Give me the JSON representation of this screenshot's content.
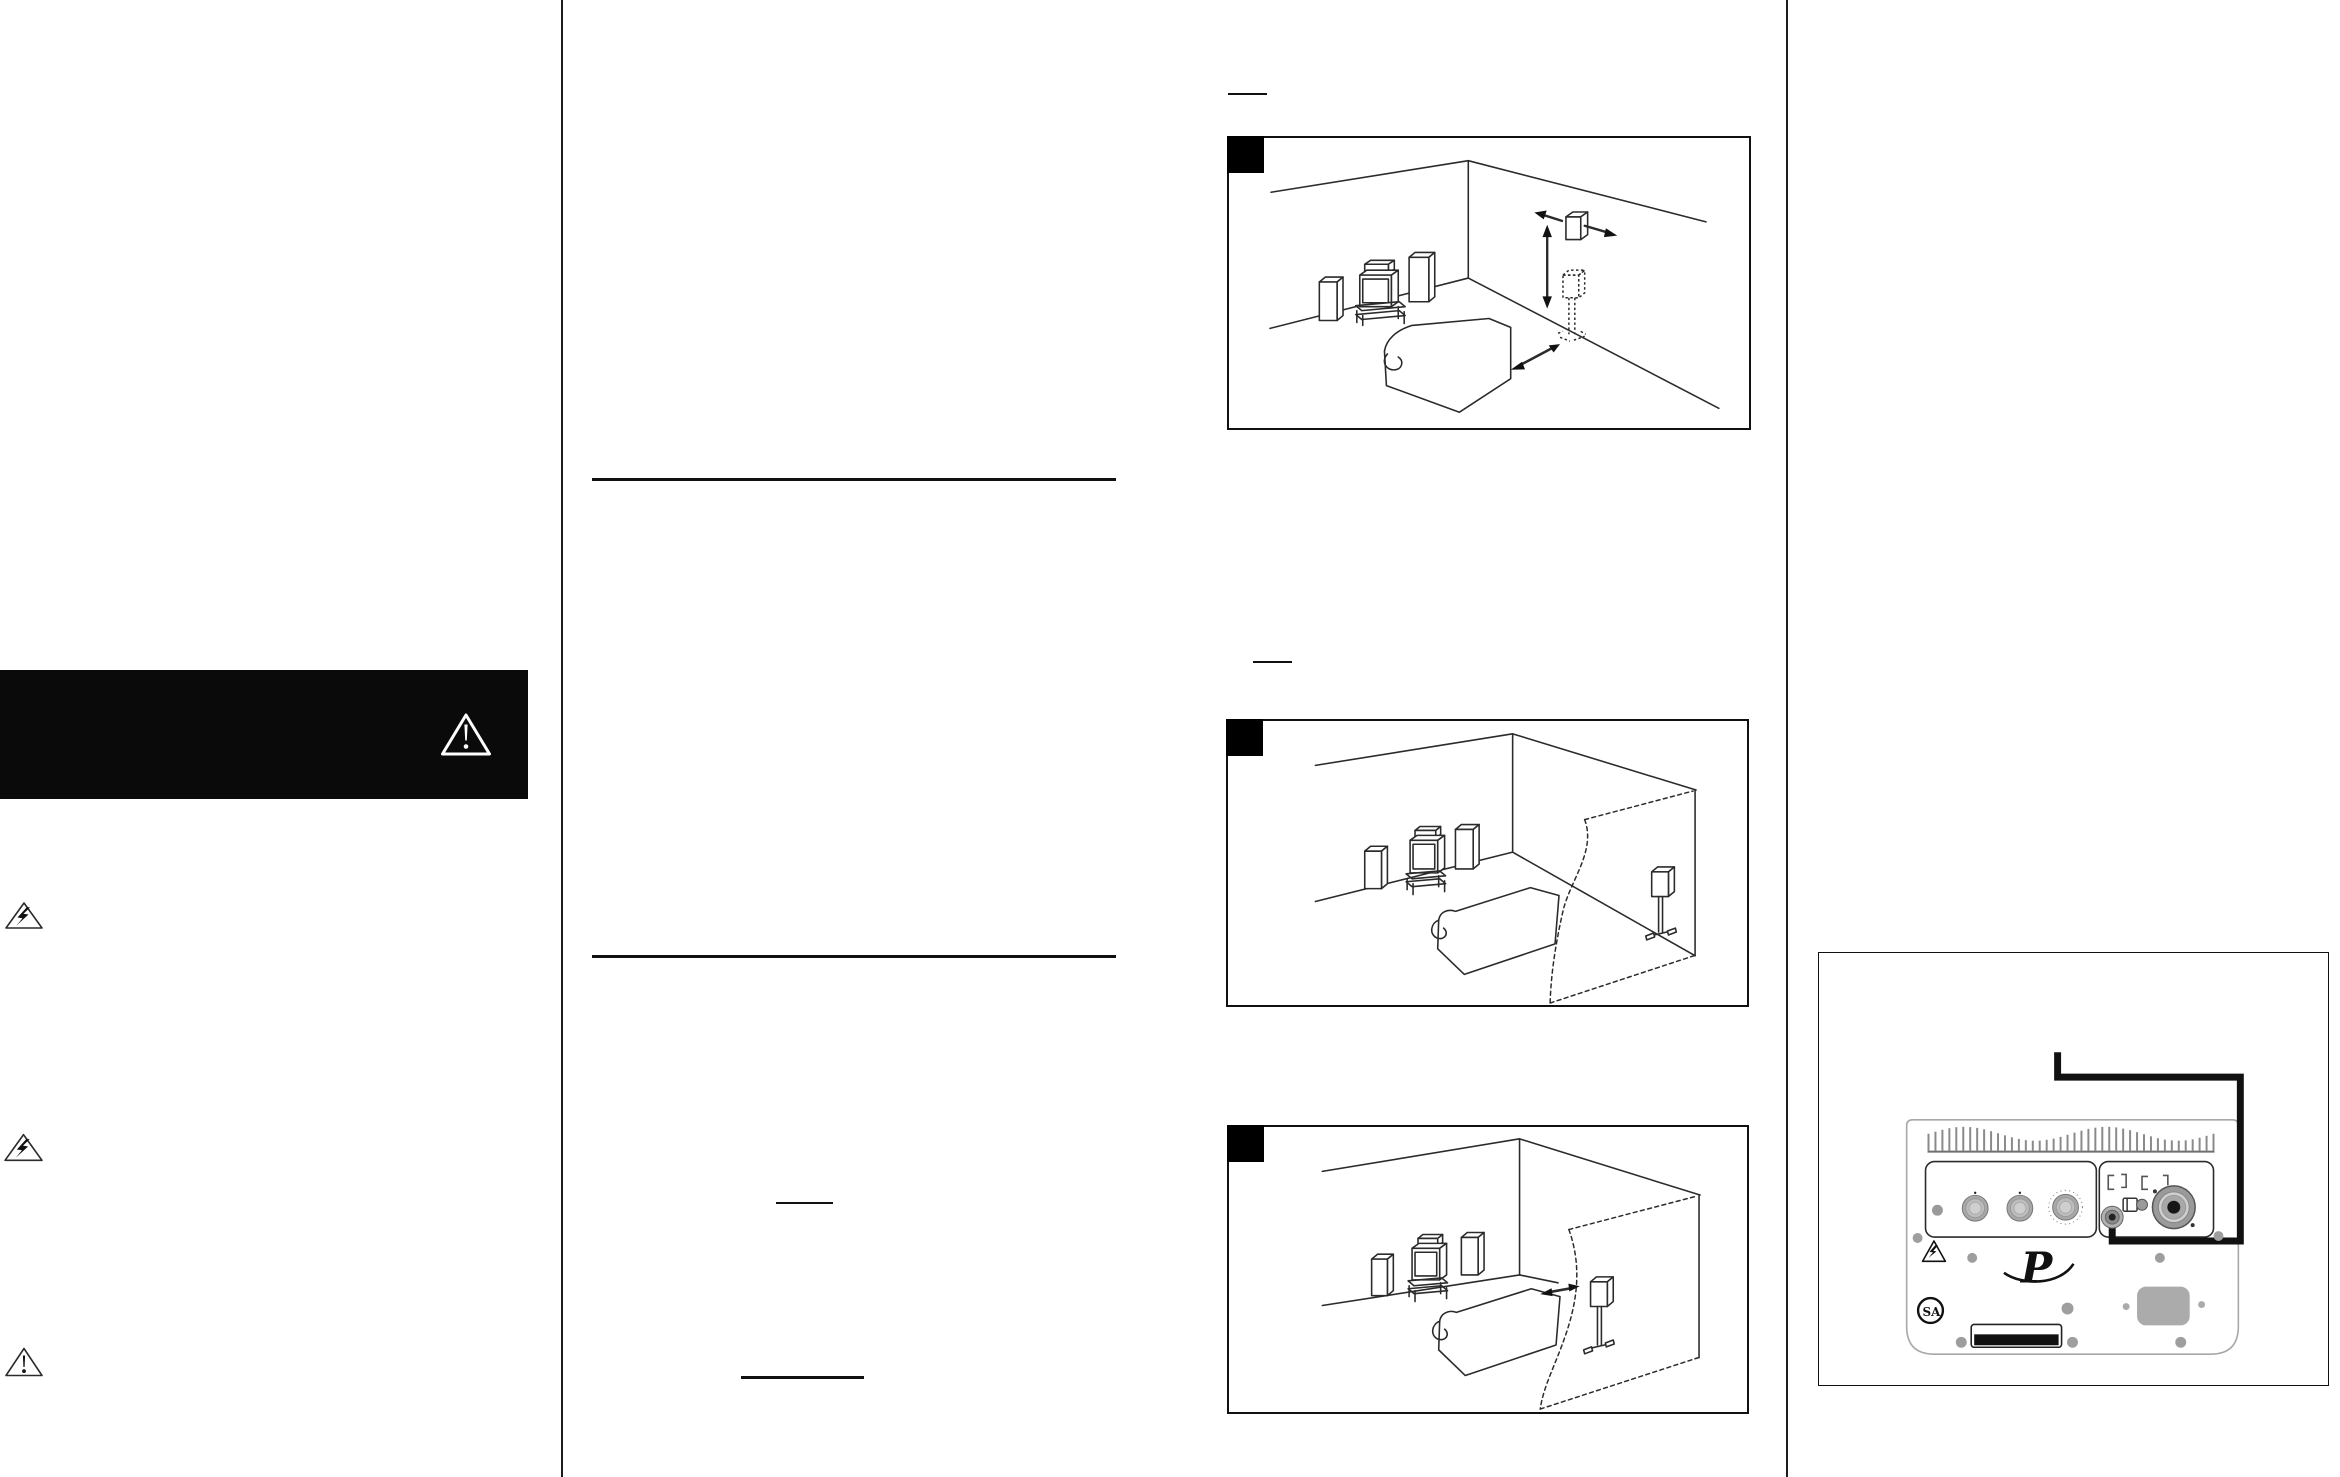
{
  "document": {
    "kind": "speaker owner's manual page (scanned)",
    "background": "#ffffff",
    "ink": "#1c1c1c",
    "metal_gray": "#a8a8a8",
    "fin_gray": "#8a8a8a"
  },
  "left_column": {
    "warning_banner": {
      "bg": "#0a0a0a",
      "icon": "warning-exclamation-triangle",
      "icon_color": "#ffffff"
    },
    "margin_icons": [
      {
        "icon": "electric-shock-lightning-triangle"
      },
      {
        "icon": "electric-shock-lightning-triangle"
      },
      {
        "icon": "caution-exclamation-triangle"
      }
    ]
  },
  "middle_column": {
    "section_rules": 2,
    "underline_marks": 2
  },
  "figures": [
    {
      "marker": "filled-black-square",
      "subject": "surround speaker height and lateral placement on side wall",
      "elements": [
        "front speakers with tv on stand",
        "sofa",
        "wall speaker",
        "left arrow",
        "right arrow",
        "vertical double arrow",
        "dotted stand position",
        "distance double arrow"
      ]
    },
    {
      "marker": "filled-black-square",
      "subject": "surround speaker on floor stand behind listening area, wall cutaway",
      "elements": [
        "front speakers with tv on stand",
        "sofa",
        "stand speaker",
        "dashed cutaway wall"
      ]
    },
    {
      "marker": "filled-black-square",
      "subject": "surround speaker on floor stand beside sofa with spacing arrow",
      "elements": [
        "front speakers with tv on stand",
        "sofa",
        "stand speaker",
        "spacing double arrow",
        "dashed cutaway wall"
      ]
    }
  ],
  "subwoofer_panel": {
    "logos": {
      "brand_script": "P",
      "certification": "SA"
    },
    "features": [
      "heatsink fins",
      "three rotary knobs",
      "status dot",
      "line-in jack with routed cable",
      "phase switch",
      "high-level input connector",
      "warning triangle",
      "label plate",
      "ac power inlet",
      "chassis screws"
    ],
    "cable_color": "#111111"
  }
}
